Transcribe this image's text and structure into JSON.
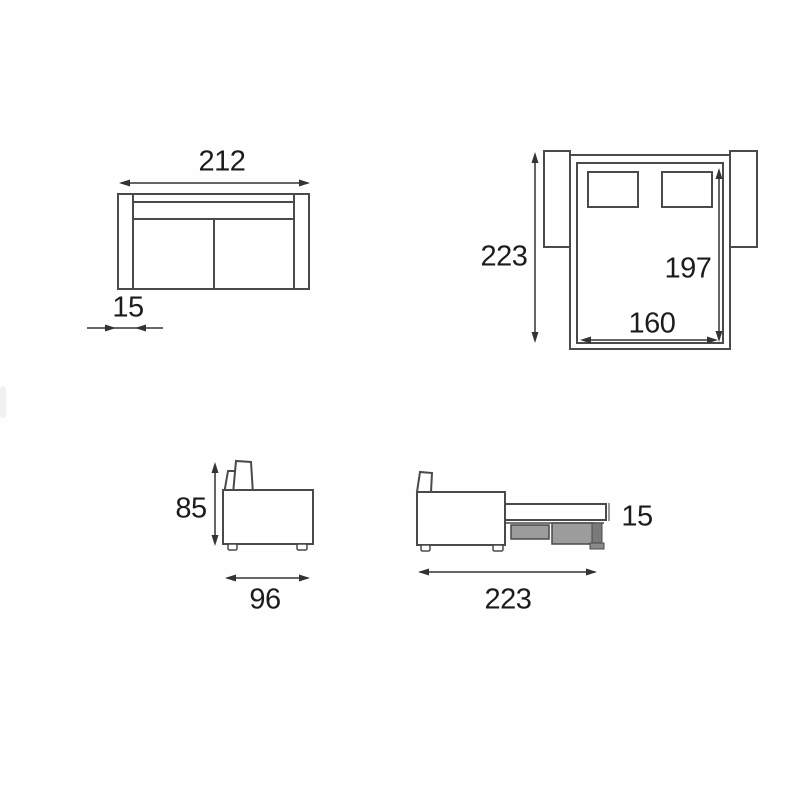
{
  "diagram": {
    "front_view": {
      "width": "212",
      "arm_width": "15"
    },
    "top_view_open": {
      "depth_total": "223",
      "bed_length": "197",
      "bed_width": "160"
    },
    "side_view_closed": {
      "height": "85",
      "depth": "96"
    },
    "side_view_open": {
      "length_total": "223",
      "mattress_thickness": "15"
    }
  },
  "colors": {
    "outline": "#4a4a4a",
    "dimension_line": "#333333",
    "text": "#1c1c1c",
    "drawer_fill": "#9c9c9c",
    "leg_fill": "#7a7a7a",
    "background": "#fefefe"
  }
}
